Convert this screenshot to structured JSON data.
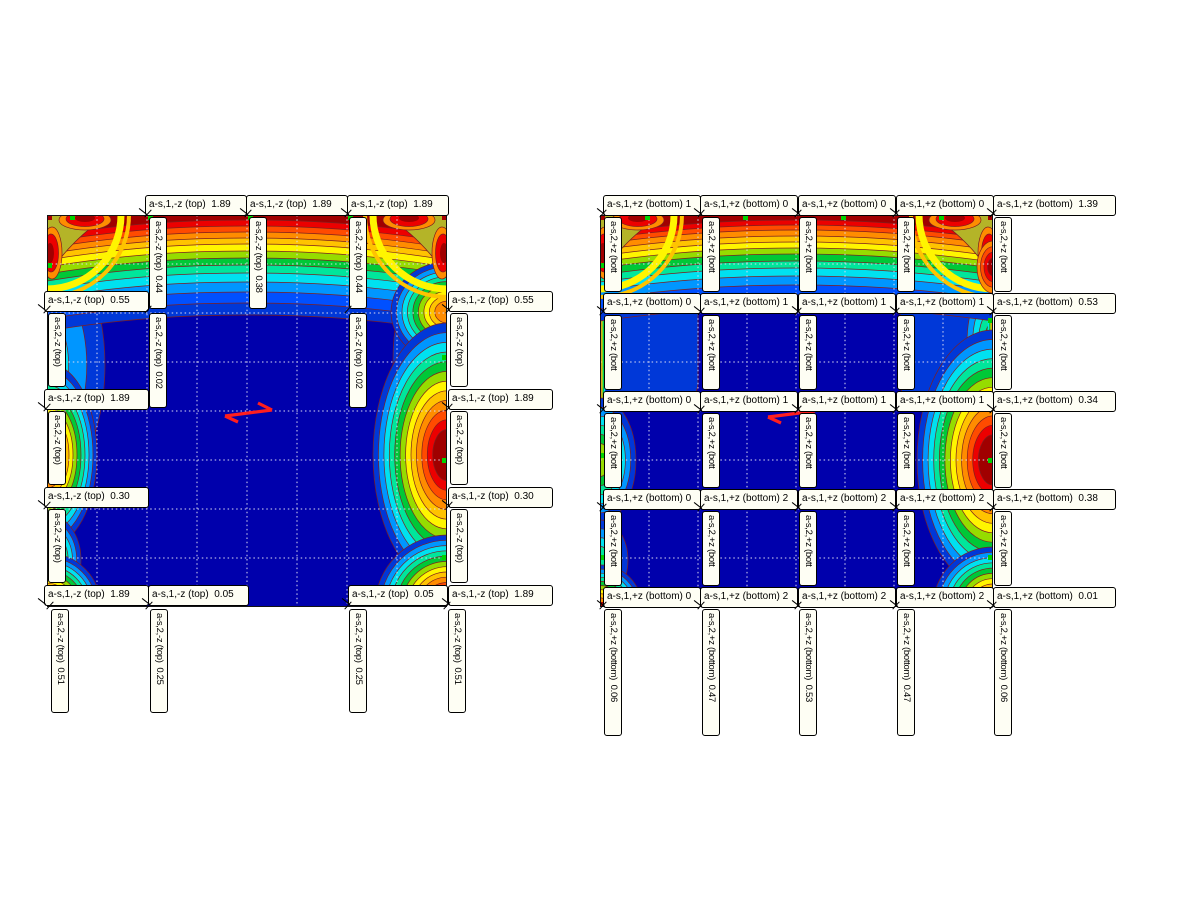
{
  "page": {
    "background": "#ffffff",
    "description": "FEM contour plots of slab reinforcement with value callouts"
  },
  "colors": {
    "field_min_blue": "#0000AC",
    "field_max_red": "#A00000",
    "band_scale_outer_to_inner": [
      "#0038D8",
      "#0096FF",
      "#00E1F0",
      "#00E69B",
      "#00C837",
      "#96DC00",
      "#FFF500",
      "#FFC300",
      "#FF8C00",
      "#FF4B00",
      "#EC0000",
      "#A00000"
    ],
    "saddle_olive": "#B4B428",
    "contour_line": "#7D1F1F",
    "grid_dots": "#DCDCF2",
    "support_marker": "#00D200",
    "node_marker": "#A80000",
    "label_bg": "#FEFEF4",
    "arrow_red": "#FF1E1E"
  },
  "left_plot": {
    "param_primary": "a-s,1,-z (top)",
    "param_secondary": "a-s,2,-z (top)",
    "top": [
      "a-s,1,-z (top)  1.89",
      "a-s,1,-z (top)  1.89",
      "a-s,1,-z (top)  1.89"
    ],
    "topv": [
      "a-s,2,-z (top)  0.44",
      "a-s,2,-z (top)  0.38",
      "a-s,2,-z (top)  0.44"
    ],
    "left": [
      "a-s,1,-z (top)  0.55",
      "a-s,1,-z (top)  1.89",
      "a-s,1,-z (top)  0.30",
      "a-s,1,-z (top)  1.89"
    ],
    "right": [
      "a-s,1,-z (top)  0.55",
      "a-s,1,-z (top)  1.89",
      "a-s,1,-z (top)  0.30",
      "a-s,1,-z (top)  1.89"
    ],
    "iv": [
      "a-s,2,-z (top)  0.02",
      "a-s,2,-z (top)  0.02"
    ],
    "edgev": "a-s,2,-z (top)",
    "bottom": [
      "a-s,1,-z (top)  0.05",
      "a-s,1,-z (top)  0.05"
    ],
    "bottomv": [
      "a-s,2,-z (top)  0.51",
      "a-s,2,-z (top)  0.25",
      "a-s,2,-z (top)  0.25",
      "a-s,2,-z (top)  0.51"
    ]
  },
  "right_plot": {
    "param_primary": "a-s,1,+z (bottom)",
    "param_secondary": "a-s,2,+z (bottom)",
    "rows": [
      [
        "a-s,1,+z (bottom) 1",
        "a-s,1,+z (bottom) 0",
        "a-s,1,+z (bottom) 0",
        "a-s,1,+z (bottom) 0",
        "a-s,1,+z (bottom)  1.39"
      ],
      [
        "a-s,1,+z (bottom) 0",
        "a-s,1,+z (bottom) 1",
        "a-s,1,+z (bottom) 1",
        "a-s,1,+z (bottom) 1",
        "a-s,1,+z (bottom)  0.53"
      ],
      [
        "a-s,1,+z (bottom) 0",
        "a-s,1,+z (bottom) 1",
        "a-s,1,+z (bottom) 1",
        "a-s,1,+z (bottom) 1",
        "a-s,1,+z (bottom)  0.34"
      ],
      [
        "a-s,1,+z (bottom) 0",
        "a-s,1,+z (bottom) 2",
        "a-s,1,+z (bottom) 2",
        "a-s,1,+z (bottom) 2",
        "a-s,1,+z (bottom)  0.38"
      ],
      [
        "a-s,1,+z (bottom) 0",
        "a-s,1,+z (bottom) 2",
        "a-s,1,+z (bottom) 2",
        "a-s,1,+z (bottom) 2",
        "a-s,1,+z (bottom)  0.01"
      ]
    ],
    "vtrunc": "a-s,2,+z (bott",
    "bottomv": [
      "a-s,2,+z (bottom)  0.06",
      "a-s,2,+z (bottom)  0.47",
      "a-s,2,+z (bottom)  0.53",
      "a-s,2,+z (bottom)  0.47",
      "a-s,2,+z (bottom)  0.06"
    ]
  },
  "chart_data": [
    {
      "type": "heatmap",
      "title": "a-s,1,-z (top) / a-s,2,-z (top) required reinforcement contour plot",
      "grid": "8x8 dotted mesh",
      "legend_position": "none",
      "labeled_values": {
        "top_edge_as1": [
          1.89,
          1.89,
          1.89
        ],
        "top_edge_as2": [
          0.44,
          0.38,
          0.44
        ],
        "left_edge_as1": [
          0.55,
          1.89,
          0.3,
          1.89
        ],
        "right_edge_as1": [
          0.55,
          1.89,
          0.3,
          1.89
        ],
        "interior_as2": [
          0.02,
          0.02
        ],
        "bottom_edge_as1": [
          1.89,
          0.05,
          0.05,
          1.89
        ],
        "bottom_edge_as2": [
          0.51,
          0.25,
          0.25,
          0.51
        ]
      },
      "field_range_colors": [
        "#0000AC",
        "#A00000"
      ]
    },
    {
      "type": "heatmap",
      "title": "a-s,1,+z (bottom) / a-s,2,+z (bottom) required reinforcement contour plot",
      "grid": "8x8 dotted mesh",
      "legend_position": "none",
      "labeled_values": {
        "row_right_values_as1": [
          1.39,
          0.53,
          0.34,
          0.38,
          0.01
        ],
        "rows_truncated_first_digits": [
          [
            "1",
            "0",
            "0",
            "0"
          ],
          [
            "0",
            "1",
            "1",
            "1"
          ],
          [
            "0",
            "1",
            "1",
            "1"
          ],
          [
            "0",
            "2",
            "2",
            "2"
          ],
          [
            "0",
            "2",
            "2",
            "2"
          ]
        ],
        "bottom_edge_as2": [
          0.06,
          0.47,
          0.53,
          0.47,
          0.06
        ]
      },
      "field_range_colors": [
        "#0000AC",
        "#A00000"
      ]
    }
  ]
}
